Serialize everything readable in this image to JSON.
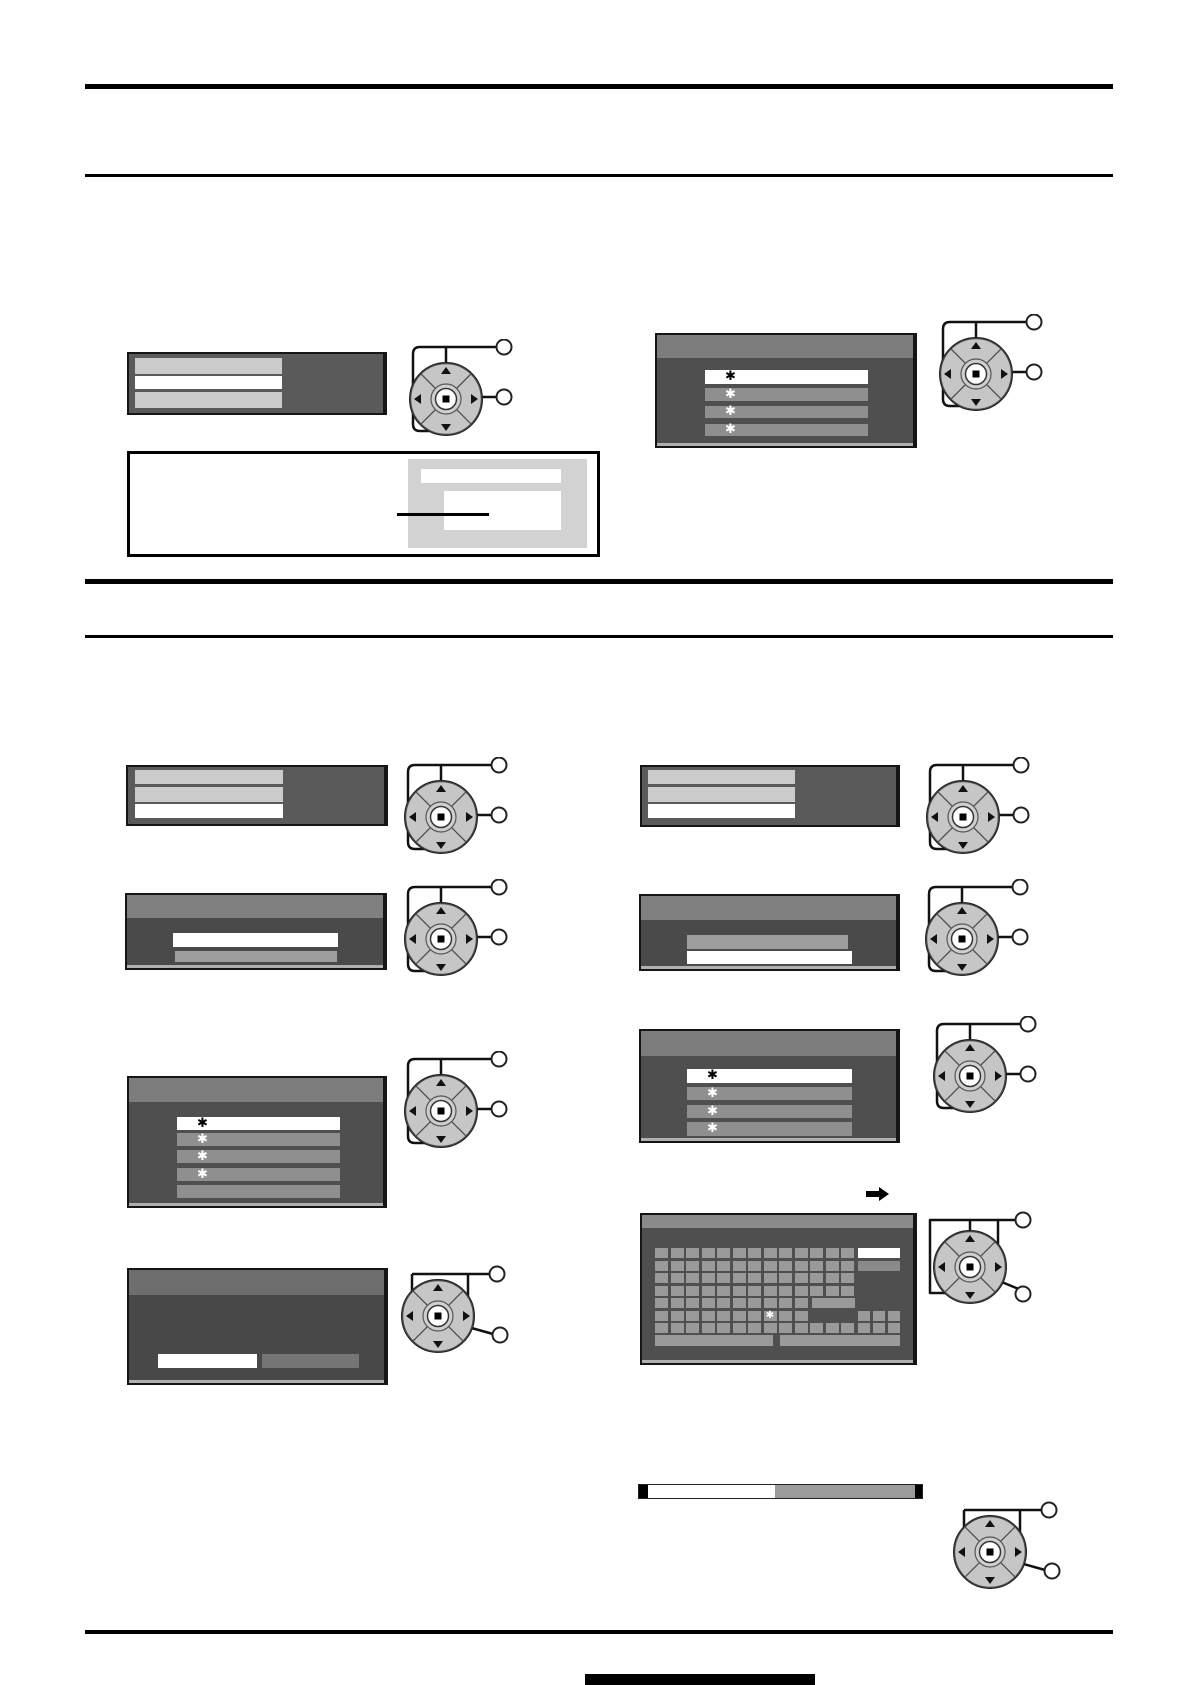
{
  "page": {
    "width": 1191,
    "height": 1685,
    "background": "#ffffff"
  },
  "glyphs": {
    "asterisk": "✱"
  },
  "colors": {
    "rule": "#000000",
    "box_body_dark": "#4f4f4f",
    "box_body_mid": "#5a5a5a",
    "title_bar": "#7d7d7d",
    "title_bar_light": "#8a8a8a",
    "title_bar_dark": "#6e6e6e",
    "row_light": "#cbcbcb",
    "row_white": "#ffffff",
    "row_gray_selectable": "#8f8f8f",
    "row_gray_light": "#9e9e9e",
    "key_gray": "#9a9a9a",
    "thumbnail_panel_gray": "#d2d2d2",
    "bar_remainder_gray": "#9b9b9b",
    "callout_line": "#111111"
  },
  "menus": {
    "top_left_menu": {
      "rows": [
        "light",
        "white",
        "light"
      ]
    },
    "top_right_menu": {
      "rows": [
        "white-asterisk",
        "gray-asterisk",
        "gray-asterisk",
        "gray-asterisk"
      ]
    },
    "mid_left_menu": {
      "rows": [
        "light",
        "light",
        "white"
      ]
    },
    "mid_right_menu": {
      "rows": [
        "light",
        "light",
        "white"
      ]
    },
    "left_dialog": {
      "rows": [
        "white",
        "gray"
      ]
    },
    "right_dialog": {
      "rows": [
        "gray",
        "white"
      ]
    },
    "left_list_menu": {
      "rows": [
        "white-asterisk",
        "gray-asterisk",
        "gray-asterisk",
        "gray-asterisk",
        "gray-plain"
      ]
    },
    "right_list_menu": {
      "rows": [
        "white-asterisk",
        "gray-asterisk",
        "gray-asterisk",
        "gray-asterisk"
      ]
    },
    "bottom_left_dialog": {
      "footer_boxes": [
        "white",
        "gray"
      ]
    }
  },
  "keyboard": {
    "cols": 13,
    "col_pitch": 15.5,
    "row_pitch": 12.5,
    "key_w": 13,
    "key_h": 10,
    "rows": [
      {
        "keys": 13
      },
      {
        "keys": 13
      },
      {
        "keys": 13
      },
      {
        "keys": 13
      },
      {
        "keys": 10,
        "wide_end": true
      },
      {
        "keys": 10,
        "asterisk_col": 8,
        "right_trio": true
      },
      {
        "keys": 13,
        "right_trio": true
      }
    ],
    "right_column": {
      "white_key": true,
      "gray_key": true,
      "x": 203,
      "w": 42
    },
    "wide_end": {
      "x": 157,
      "w": 43
    },
    "trio_x": [
      203,
      218,
      233
    ],
    "space_bars": [
      {
        "x": 0,
        "w": 118
      },
      {
        "x": 125,
        "w": 120
      }
    ]
  },
  "progress": {
    "filled_fraction": 0.45
  },
  "dpad": {
    "callout_circles_per_dpad": 2
  }
}
